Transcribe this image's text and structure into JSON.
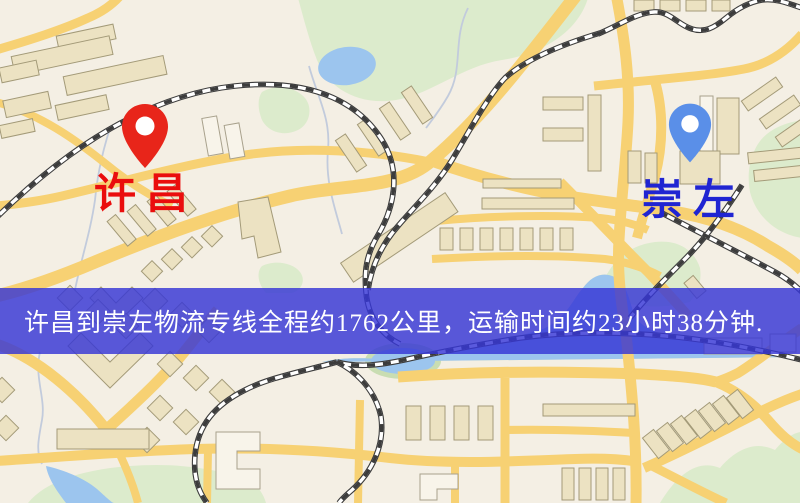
{
  "map": {
    "origin": {
      "label": "许昌",
      "label_color": "#ea0d0d",
      "pin_color": "#e8251a"
    },
    "destination": {
      "label": "崇左",
      "label_color": "#2025d2",
      "pin_color": "#5a8fe8"
    },
    "banner": {
      "text": "许昌到崇左物流专线全程约1762公里，运输时间约23小时38分钟.",
      "background_color": "#3636d6",
      "text_color": "#ffffff"
    },
    "palette": {
      "background": "#f4efe4",
      "road": "#f7d173",
      "park": "#dcebcc",
      "water": "#9cc5ee",
      "river_bank": "#c9ddb2",
      "railway": "#3c3c3c",
      "building": "#ece2c2"
    }
  }
}
